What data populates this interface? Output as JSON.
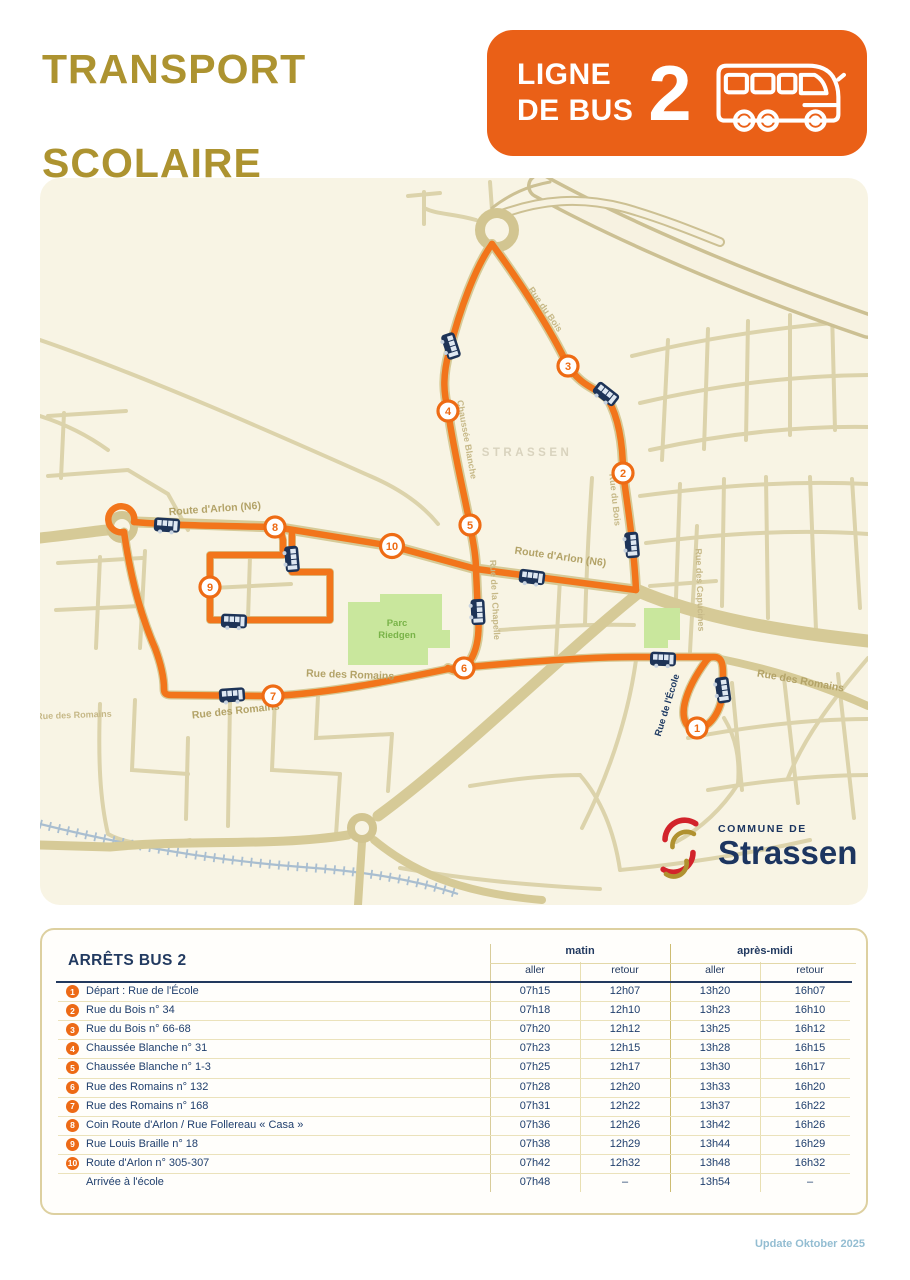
{
  "page": {
    "title_line1": "TRANSPORT",
    "title_line2": "SCOLAIRE",
    "footer": "Update Oktober 2025"
  },
  "badge": {
    "line1": "LIGNE",
    "line2": "DE BUS",
    "number": "2"
  },
  "logo": {
    "small": "COMMUNE DE",
    "name": "Strassen"
  },
  "map": {
    "watermark": "STRASSEN",
    "labels": [
      {
        "t": "Route d'Arlon (N6)",
        "x": 175,
        "y": 334,
        "r": -4,
        "c": "road"
      },
      {
        "t": "Route d'Arlon (N6)",
        "x": 520,
        "y": 382,
        "r": 8,
        "c": "road"
      },
      {
        "t": "Chaussée Blanche",
        "x": 424,
        "y": 262,
        "r": 80,
        "c": "roadsm"
      },
      {
        "t": "Rue du Bois",
        "x": 503,
        "y": 133,
        "r": 55,
        "c": "roadsm"
      },
      {
        "t": "Rue du Bois",
        "x": 572,
        "y": 322,
        "r": 84,
        "c": "roadsm"
      },
      {
        "t": "Rue de la Chapelle",
        "x": 452,
        "y": 422,
        "r": 87,
        "c": "roadsm"
      },
      {
        "t": "Rue de l'École",
        "x": 630,
        "y": 528,
        "r": -73,
        "c": "dark"
      },
      {
        "t": "Rue des Romains",
        "x": 196,
        "y": 536,
        "r": -6,
        "c": "road"
      },
      {
        "t": "Rue des Romains",
        "x": 310,
        "y": 500,
        "r": 2,
        "c": "road"
      },
      {
        "t": "Rue des Romains",
        "x": 760,
        "y": 506,
        "r": 10,
        "c": "road"
      },
      {
        "t": "Rue des Romains",
        "x": 34,
        "y": 540,
        "r": -2,
        "c": "roadsm"
      },
      {
        "t": "Rue des Capucines",
        "x": 657,
        "y": 412,
        "r": 88,
        "c": "roadsm"
      },
      {
        "t": "STRASSEN",
        "x": 487,
        "y": 278,
        "r": 0,
        "c": "watermark"
      },
      {
        "t": "Parc",
        "x": 357,
        "y": 448,
        "r": 0,
        "c": "park"
      },
      {
        "t": "Riedgen",
        "x": 357,
        "y": 460,
        "r": 0,
        "c": "park"
      }
    ],
    "stops": [
      {
        "n": "1",
        "x": 657,
        "y": 550
      },
      {
        "n": "2",
        "x": 583,
        "y": 295
      },
      {
        "n": "3",
        "x": 528,
        "y": 188
      },
      {
        "n": "4",
        "x": 408,
        "y": 233
      },
      {
        "n": "5",
        "x": 430,
        "y": 347
      },
      {
        "n": "6",
        "x": 424,
        "y": 490
      },
      {
        "n": "7",
        "x": 233,
        "y": 518
      },
      {
        "n": "8",
        "x": 235,
        "y": 349
      },
      {
        "n": "9",
        "x": 170,
        "y": 409
      },
      {
        "n": "10",
        "x": 352,
        "y": 368
      }
    ],
    "buses": [
      {
        "x": 127,
        "y": 347,
        "r": 4
      },
      {
        "x": 411,
        "y": 168,
        "r": 72
      },
      {
        "x": 566,
        "y": 216,
        "r": 38
      },
      {
        "x": 592,
        "y": 367,
        "r": 85
      },
      {
        "x": 252,
        "y": 381,
        "r": 85
      },
      {
        "x": 194,
        "y": 443,
        "r": 2
      },
      {
        "x": 438,
        "y": 434,
        "r": 87
      },
      {
        "x": 492,
        "y": 399,
        "r": 7
      },
      {
        "x": 623,
        "y": 481,
        "r": 2
      },
      {
        "x": 683,
        "y": 512,
        "r": 82
      },
      {
        "x": 192,
        "y": 517,
        "r": -4
      }
    ]
  },
  "table": {
    "title": "ARRÊTS BUS 2",
    "groups": [
      "matin",
      "après-midi"
    ],
    "subheaders": [
      "aller",
      "retour",
      "aller",
      "retour"
    ],
    "rows": [
      {
        "n": "1",
        "name": "Départ : Rue de l'École",
        "times": [
          "07h15",
          "12h07",
          "13h20",
          "16h07"
        ]
      },
      {
        "n": "2",
        "name": "Rue du Bois n° 34",
        "times": [
          "07h18",
          "12h10",
          "13h23",
          "16h10"
        ]
      },
      {
        "n": "3",
        "name": "Rue du Bois n° 66-68",
        "times": [
          "07h20",
          "12h12",
          "13h25",
          "16h12"
        ]
      },
      {
        "n": "4",
        "name": "Chaussée Blanche n° 31",
        "times": [
          "07h23",
          "12h15",
          "13h28",
          "16h15"
        ]
      },
      {
        "n": "5",
        "name": "Chaussée Blanche n° 1-3",
        "times": [
          "07h25",
          "12h17",
          "13h30",
          "16h17"
        ]
      },
      {
        "n": "6",
        "name": "Rue des Romains n° 132",
        "times": [
          "07h28",
          "12h20",
          "13h33",
          "16h20"
        ]
      },
      {
        "n": "7",
        "name": "Rue des Romains n° 168",
        "times": [
          "07h31",
          "12h22",
          "13h37",
          "16h22"
        ]
      },
      {
        "n": "8",
        "name": "Coin Route d'Arlon / Rue Follereau « Casa »",
        "times": [
          "07h36",
          "12h26",
          "13h42",
          "16h26"
        ]
      },
      {
        "n": "9",
        "name": "Rue Louis Braille n° 18",
        "times": [
          "07h38",
          "12h29",
          "13h44",
          "16h29"
        ]
      },
      {
        "n": "10",
        "name": "Route d'Arlon n° 305-307",
        "times": [
          "07h42",
          "12h32",
          "13h48",
          "16h32"
        ]
      },
      {
        "n": "",
        "name": "Arrivée à l'école",
        "times": [
          "07h48",
          "–",
          "13h54",
          "–"
        ]
      }
    ]
  }
}
